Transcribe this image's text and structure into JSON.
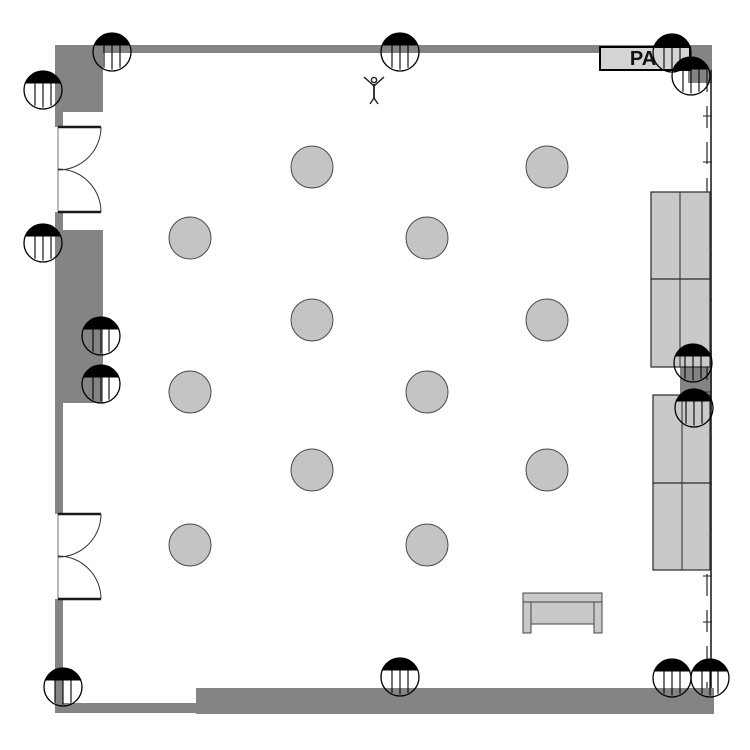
{
  "canvas": {
    "width": 750,
    "height": 750,
    "background": "#ffffff"
  },
  "colors": {
    "wall": "#848484",
    "line": "#000000",
    "door_line": "#1a1a1a",
    "opening_line": "#8a8a8a",
    "table_fill": "#c4c4c4",
    "table_stroke": "#4a4a4a",
    "couch_fill": "#c9c9c9",
    "couch_stroke": "#2a2a2a",
    "bench_fill": "#c9c9c9",
    "bench_stroke": "#444444",
    "pa_fill": "#d4d4d4",
    "pa_border": "#000000",
    "pa_text_color": "#111111"
  },
  "pa_box": {
    "text": "PA",
    "x": 600,
    "y": 47,
    "w": 90,
    "h": 23,
    "font_size": 20
  },
  "walls": [
    {
      "name": "top-wall",
      "x": 56,
      "y": 45,
      "w": 656,
      "h": 8
    },
    {
      "name": "top-right-corner-block",
      "x": 688,
      "y": 45,
      "w": 24,
      "h": 38
    },
    {
      "name": "top-left-block",
      "x": 55,
      "y": 45,
      "w": 48,
      "h": 67
    },
    {
      "name": "left-wall-upper",
      "x": 55,
      "y": 112,
      "w": 8,
      "h": 15
    },
    {
      "name": "left-wall-between-doors",
      "x": 55,
      "y": 212,
      "w": 8,
      "h": 18
    },
    {
      "name": "mid-left-block",
      "x": 55,
      "y": 230,
      "w": 48,
      "h": 173
    },
    {
      "name": "left-wall-mid",
      "x": 55,
      "y": 403,
      "w": 8,
      "h": 111
    },
    {
      "name": "left-wall-lower",
      "x": 55,
      "y": 599,
      "w": 8,
      "h": 114
    },
    {
      "name": "bottom-wall-thin",
      "x": 55,
      "y": 703,
      "w": 141,
      "h": 10
    },
    {
      "name": "bottom-wall-thick",
      "x": 196,
      "y": 688,
      "w": 518,
      "h": 26
    },
    {
      "name": "right-mid-block",
      "x": 680,
      "y": 350,
      "w": 32,
      "h": 60
    }
  ],
  "right_wall": {
    "x_outer": 711,
    "x_inner": 707,
    "y_top": 70,
    "y_bottom": 688,
    "dash": "22 14",
    "tick_x1": 703,
    "tick_x2": 712,
    "tick_ys": [
      116,
      162,
      208,
      254,
      300,
      346,
      392,
      438,
      484,
      530,
      576,
      622,
      668
    ]
  },
  "doors": [
    {
      "name": "door-upper",
      "wall_x": 58,
      "leaf_end_x": 101,
      "top_y": 127,
      "bottom_y": 212,
      "radius": 43
    },
    {
      "name": "door-lower",
      "wall_x": 58,
      "leaf_end_x": 101,
      "top_y": 514,
      "bottom_y": 599,
      "radius": 43
    }
  ],
  "tables": {
    "radius": 21,
    "centers": [
      [
        312,
        167
      ],
      [
        547,
        167
      ],
      [
        190,
        238
      ],
      [
        427,
        238
      ],
      [
        312,
        320
      ],
      [
        547,
        320
      ],
      [
        190,
        392
      ],
      [
        427,
        392
      ],
      [
        312,
        470
      ],
      [
        547,
        470
      ],
      [
        190,
        545
      ],
      [
        427,
        545
      ]
    ]
  },
  "speakers": {
    "radius": 19,
    "cap_chord_y": -6.5,
    "line_offsets": [
      -8,
      0,
      8
    ],
    "centers": [
      [
        112,
        52
      ],
      [
        43,
        90
      ],
      [
        43,
        243
      ],
      [
        101,
        336
      ],
      [
        101,
        384
      ],
      [
        400,
        52
      ],
      [
        672,
        53
      ],
      [
        691,
        76
      ],
      [
        693,
        363
      ],
      [
        694,
        408
      ],
      [
        63,
        687
      ],
      [
        400,
        677
      ],
      [
        672,
        678
      ],
      [
        710,
        678
      ]
    ]
  },
  "couches": [
    {
      "name": "sofa-upper",
      "x": 651,
      "y": 192,
      "w": 59,
      "h": 175,
      "divider_x": 680,
      "divider_y": 279
    },
    {
      "name": "sofa-lower",
      "x": 653,
      "y": 395,
      "w": 57,
      "h": 175,
      "divider_x": 682,
      "divider_y": 483
    }
  ],
  "bench": {
    "x": 523,
    "y": 593,
    "w": 79,
    "slab_h": 9,
    "leg_w": 8,
    "leg_h": 31,
    "inner": {
      "x": 531,
      "y": 602,
      "w": 63,
      "h": 22
    }
  },
  "person": {
    "cx": 374,
    "cy": 80
  }
}
